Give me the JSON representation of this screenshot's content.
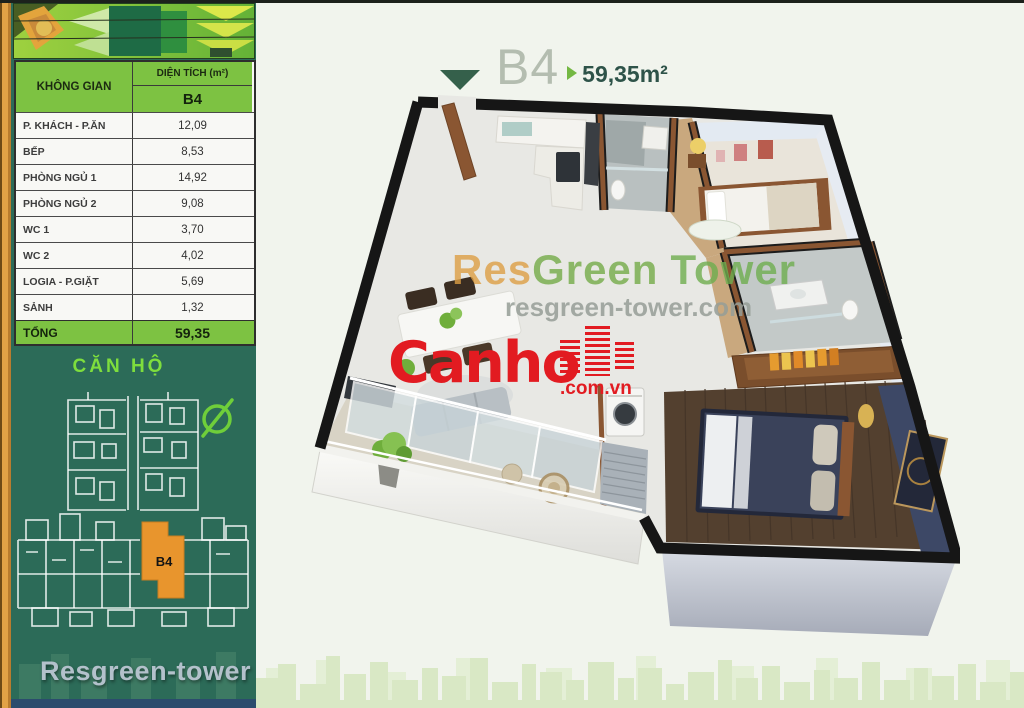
{
  "colors": {
    "accent_green": "#7dc242",
    "sidebar_green": "#2c6b58",
    "frame_orange": "#e2a246",
    "highlight_orange": "#e8952d",
    "logo_red": "#e21b21",
    "footer_blue": "#2b4c6d",
    "title_triangle": "#35604b",
    "title_arrow": "#74b843"
  },
  "sidebar": {
    "table": {
      "space_header": "KHÔNG GIAN",
      "area_header": "DIỆN TÍCH (m²)",
      "unit_header": "B4",
      "rows": [
        {
          "label": "P. KHÁCH - P.ĂN",
          "value": "12,09"
        },
        {
          "label": "BẾP",
          "value": "8,53"
        },
        {
          "label": "PHÒNG NGỦ 1",
          "value": "14,92"
        },
        {
          "label": "PHÒNG NGỦ 2",
          "value": "9,08"
        },
        {
          "label": "WC 1",
          "value": "3,70"
        },
        {
          "label": "WC 2",
          "value": "4,02"
        },
        {
          "label": "LOGIA - P.GIẶT",
          "value": "5,69"
        },
        {
          "label": "SẢNH",
          "value": "1,32"
        }
      ],
      "total_label": "TỔNG",
      "total_value": "59,35"
    },
    "section_label": "CĂN HỘ",
    "plan_highlight": {
      "label": "B4"
    },
    "footer_brand": "Resgreen-tower"
  },
  "title": {
    "unit": "B4",
    "area": "59,35m²"
  },
  "watermark": {
    "brand_res": "Res",
    "brand_green": "Green",
    "brand_tower": "Tower",
    "site": "resgreen-tower.com"
  },
  "logo": {
    "name": "Canho",
    "domain": ".com.vn"
  }
}
